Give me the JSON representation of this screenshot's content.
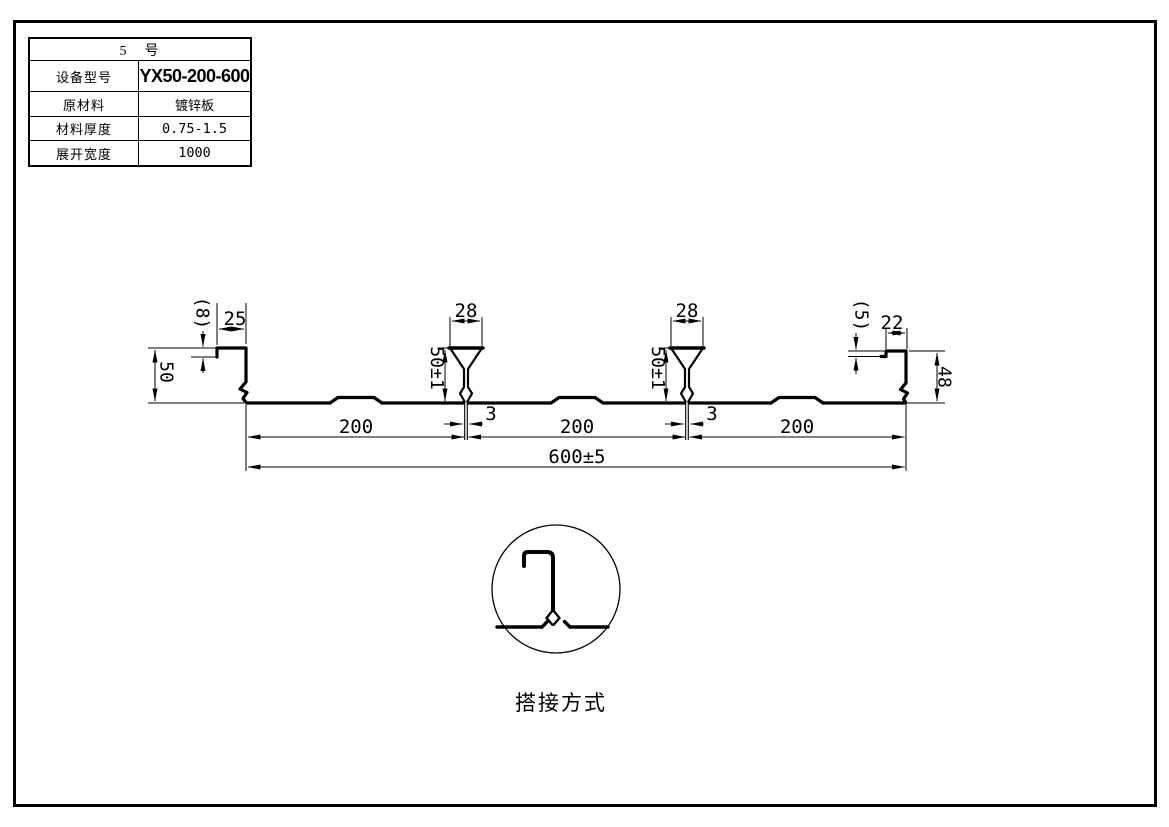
{
  "spec_table": {
    "title": "5　号",
    "rows": [
      {
        "label": "设备型号",
        "value": "YX50-200-600"
      },
      {
        "label": "原材料",
        "value": "镀锌板"
      },
      {
        "label": "材料厚度",
        "value": "0.75-1.5"
      },
      {
        "label": "展开宽度",
        "value": "1000"
      }
    ]
  },
  "profile": {
    "line_color": "#000000",
    "background": "#ffffff",
    "dimensions": {
      "left_hook_height": "(8)",
      "left_lip_width": "25",
      "rib1_top_width": "28",
      "rib2_top_width": "28",
      "right_hook_height": "(5)",
      "right_lip_width": "22",
      "left_height": "50",
      "rib1_height": "50±1",
      "rib2_height": "50±1",
      "right_height": "48",
      "rib1_seam_gap": "3",
      "rib2_seam_gap": "3",
      "pitch1": "200",
      "pitch2": "200",
      "pitch3": "200",
      "overall_width": "600±5"
    }
  },
  "detail": {
    "caption": "搭接方式"
  }
}
